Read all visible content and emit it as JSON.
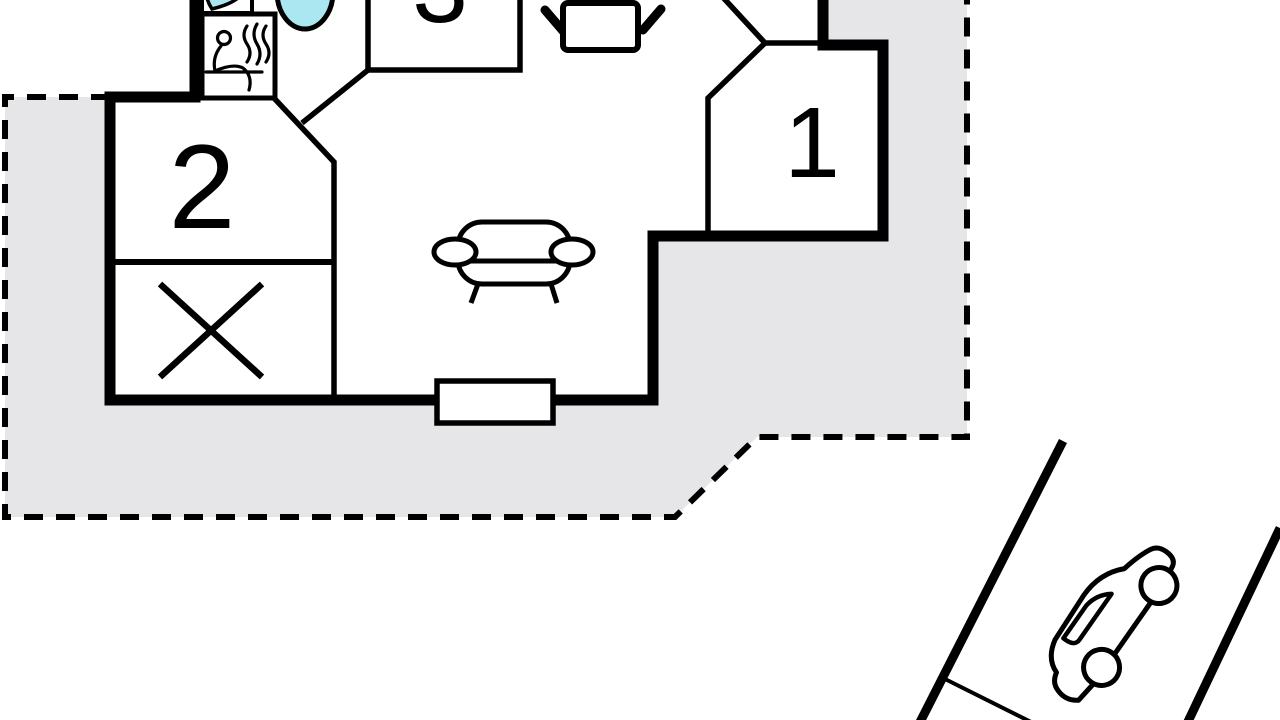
{
  "title": "holiday-home-floor-plan",
  "colors": {
    "plot_fill": "#e6e5e8",
    "line": "#000000",
    "water_fill": "#aae7f0",
    "room_fill": "#ffffff"
  },
  "rooms": [
    {
      "id": "room-1",
      "label": "1"
    },
    {
      "id": "room-2",
      "label": "2"
    },
    {
      "id": "room-3",
      "label": "3"
    }
  ],
  "icons": [
    {
      "name": "washbasin-icon"
    },
    {
      "name": "sauna-icon"
    },
    {
      "name": "whirlpool-tub-icon"
    },
    {
      "name": "dining-table-icon"
    },
    {
      "name": "sofa-icon"
    },
    {
      "name": "terrace-door"
    },
    {
      "name": "closed-room-cross-icon"
    },
    {
      "name": "car-icon"
    },
    {
      "name": "driveway"
    }
  ]
}
